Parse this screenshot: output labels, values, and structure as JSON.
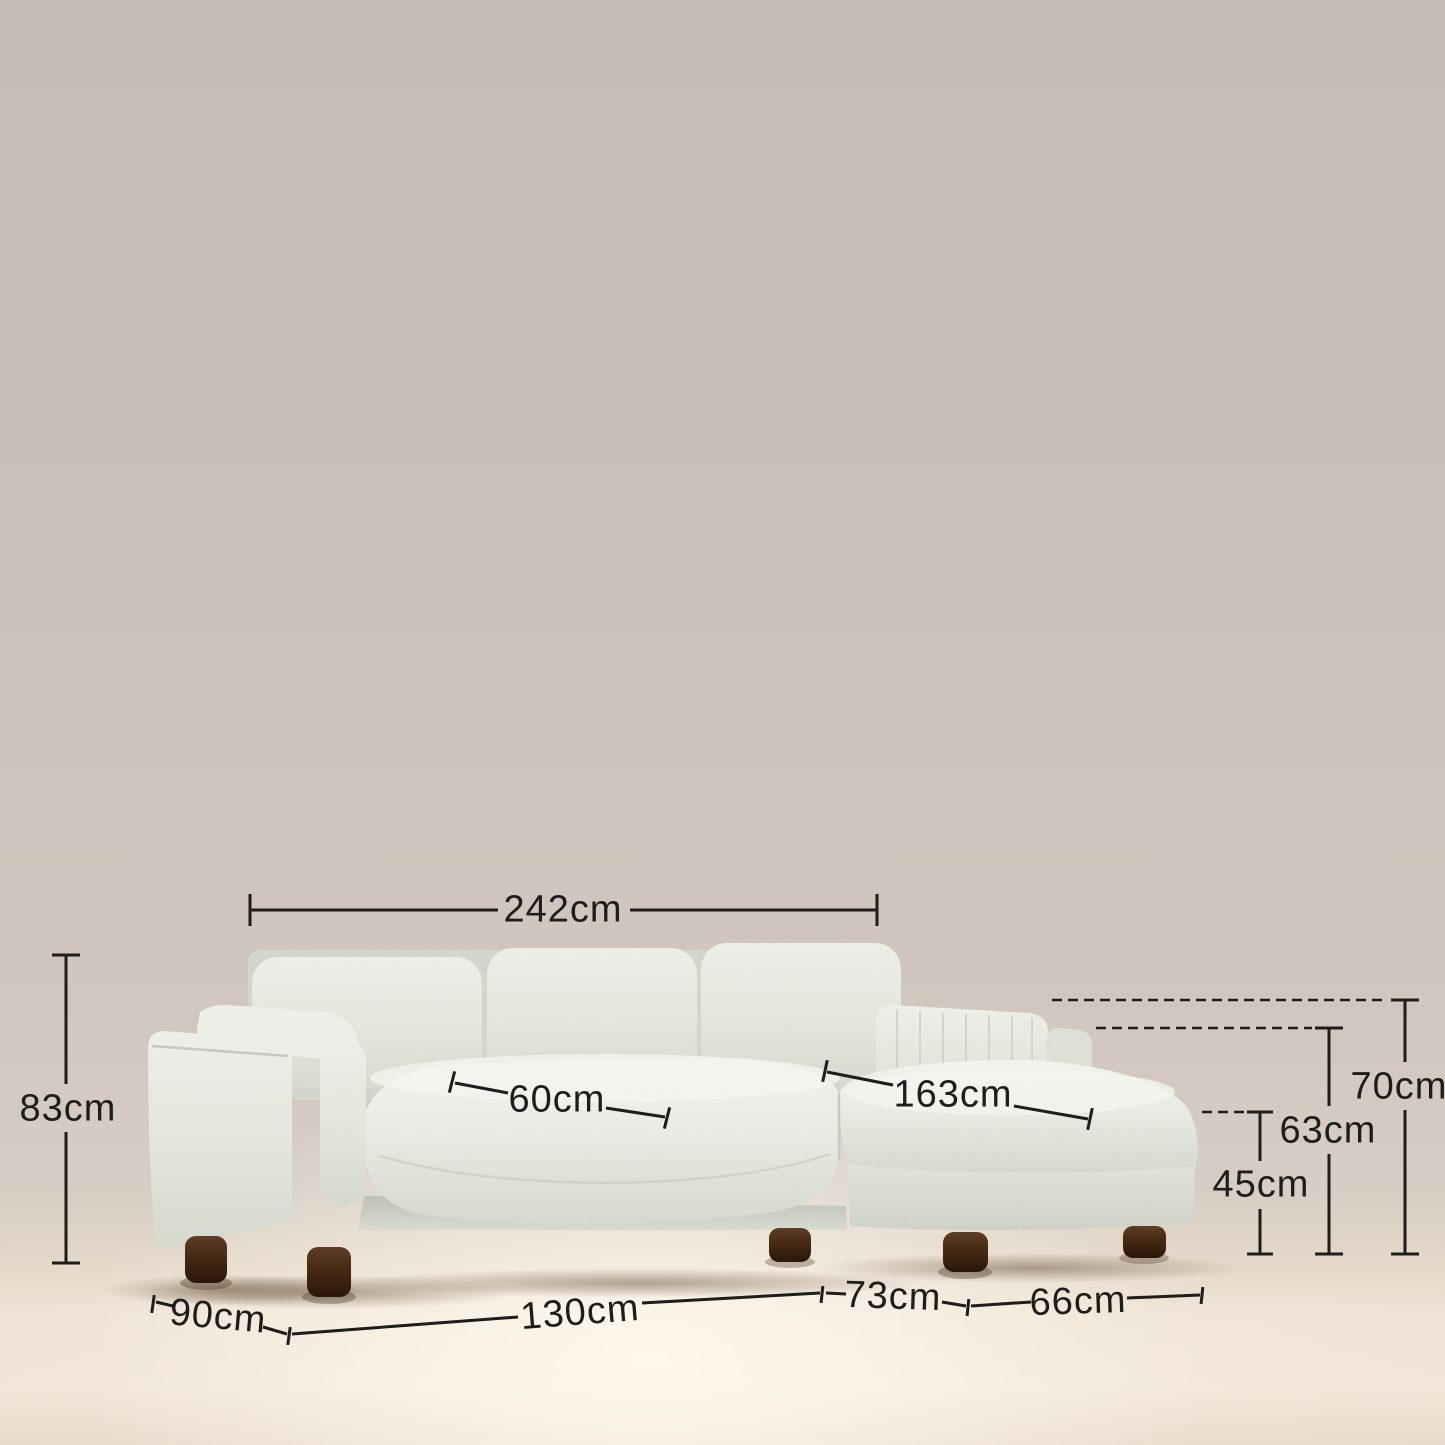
{
  "page": {
    "title": "Sectional sofa with chaise — dimensions diagram"
  },
  "product": {
    "type": "3-seater sectional sofa with right chaise",
    "fabric": "light grey boucle",
    "legs": "dark walnut cylinders",
    "units": "cm"
  },
  "measurements": {
    "overall_width": "242cm",
    "overall_height": "83cm",
    "seat_depth": "60cm",
    "chaise_length": "163cm",
    "arm_height": "70cm",
    "back_height": "63cm",
    "seat_height": "45cm",
    "side_depth": "90cm",
    "seat_width": "130cm",
    "inner_chaise_width": "73cm",
    "chaise_width": "66cm"
  },
  "colors": {
    "wall": "#cbc1ba",
    "floor": "#f4e9da",
    "fabric": "#e2e5dd",
    "fabric_shadow": "#c6cbbf",
    "fabric_highlight": "#eff1ea",
    "legs": "#45290f",
    "annotation": "#1d1d1b"
  }
}
